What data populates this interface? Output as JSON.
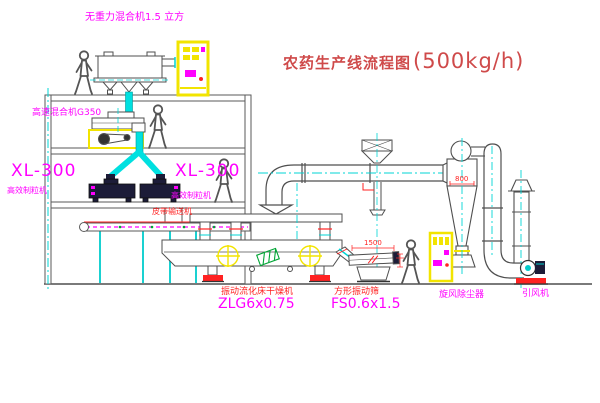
{
  "title": {
    "name": "农药生产线流程图",
    "capacity": "(500kg/h)"
  },
  "equipment": {
    "gravity_mixer": {
      "label": "无重力混合机1.5 立方"
    },
    "high_speed_mixer": {
      "label": "高速混合机G350"
    },
    "granulator_left": {
      "model": "XL-300",
      "name": "高效制粒机"
    },
    "granulator_right": {
      "model": "XL-300",
      "name": "高效制粒机"
    },
    "belt_conveyor": {
      "label": "皮带输送机"
    },
    "fluid_bed_dryer": {
      "name": "振动流化床干燥机",
      "model": "ZLG6x0.75"
    },
    "vibrating_sieve": {
      "name": "方形振动筛",
      "model": "FS0.6x1.5",
      "dimension": "1500"
    },
    "cyclone": {
      "name": "旋风除尘器",
      "dimension": "800"
    },
    "draft_fan": {
      "name": "引风机"
    }
  },
  "colors": {
    "line_gray": "#4f4f4f",
    "accent_cyan": "#00d5d5",
    "accent_yellow": "#f2e400",
    "accent_magenta": "#ff00ff",
    "accent_red": "#ff2222",
    "accent_green": "#00a535",
    "title_red": "#cf4a4a",
    "dark_fill": "#1c1c38"
  }
}
